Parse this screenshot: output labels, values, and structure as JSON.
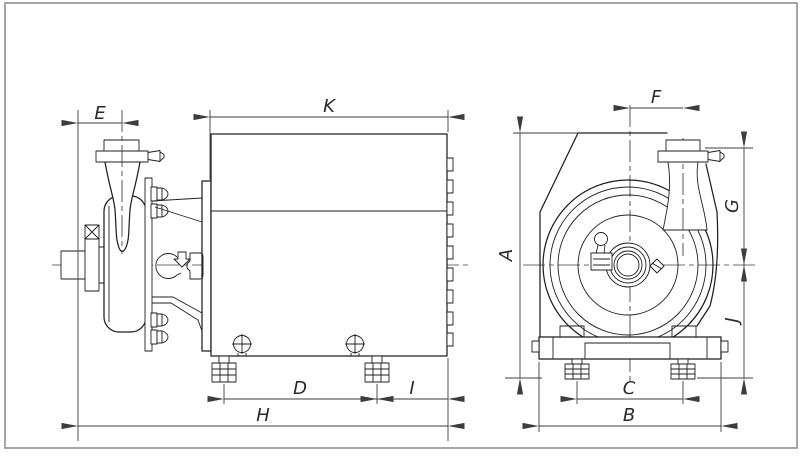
{
  "drawing": {
    "subject": "Sanitary centrifugal pump with motor - dimensional outline drawing, two orthographic views",
    "views": [
      {
        "id": "side",
        "name": "Side view (pump and motor from the left)",
        "dimensions": [
          "E",
          "K",
          "D",
          "I",
          "H"
        ]
      },
      {
        "id": "front",
        "name": "Front view (pump suction end)",
        "dimensions": [
          "F",
          "A",
          "G",
          "J",
          "C",
          "B"
        ]
      }
    ],
    "dimensions": {
      "E": "E",
      "K": "K",
      "D": "D",
      "I": "I",
      "H": "H",
      "F": "F",
      "A": "A",
      "G": "G",
      "J": "J",
      "C": "C",
      "B": "B"
    },
    "colors": {
      "background": "#ffffff",
      "frame": "#8f8f8f",
      "outline": "#1f1f1f",
      "dimension": "#3d3d3d"
    }
  }
}
